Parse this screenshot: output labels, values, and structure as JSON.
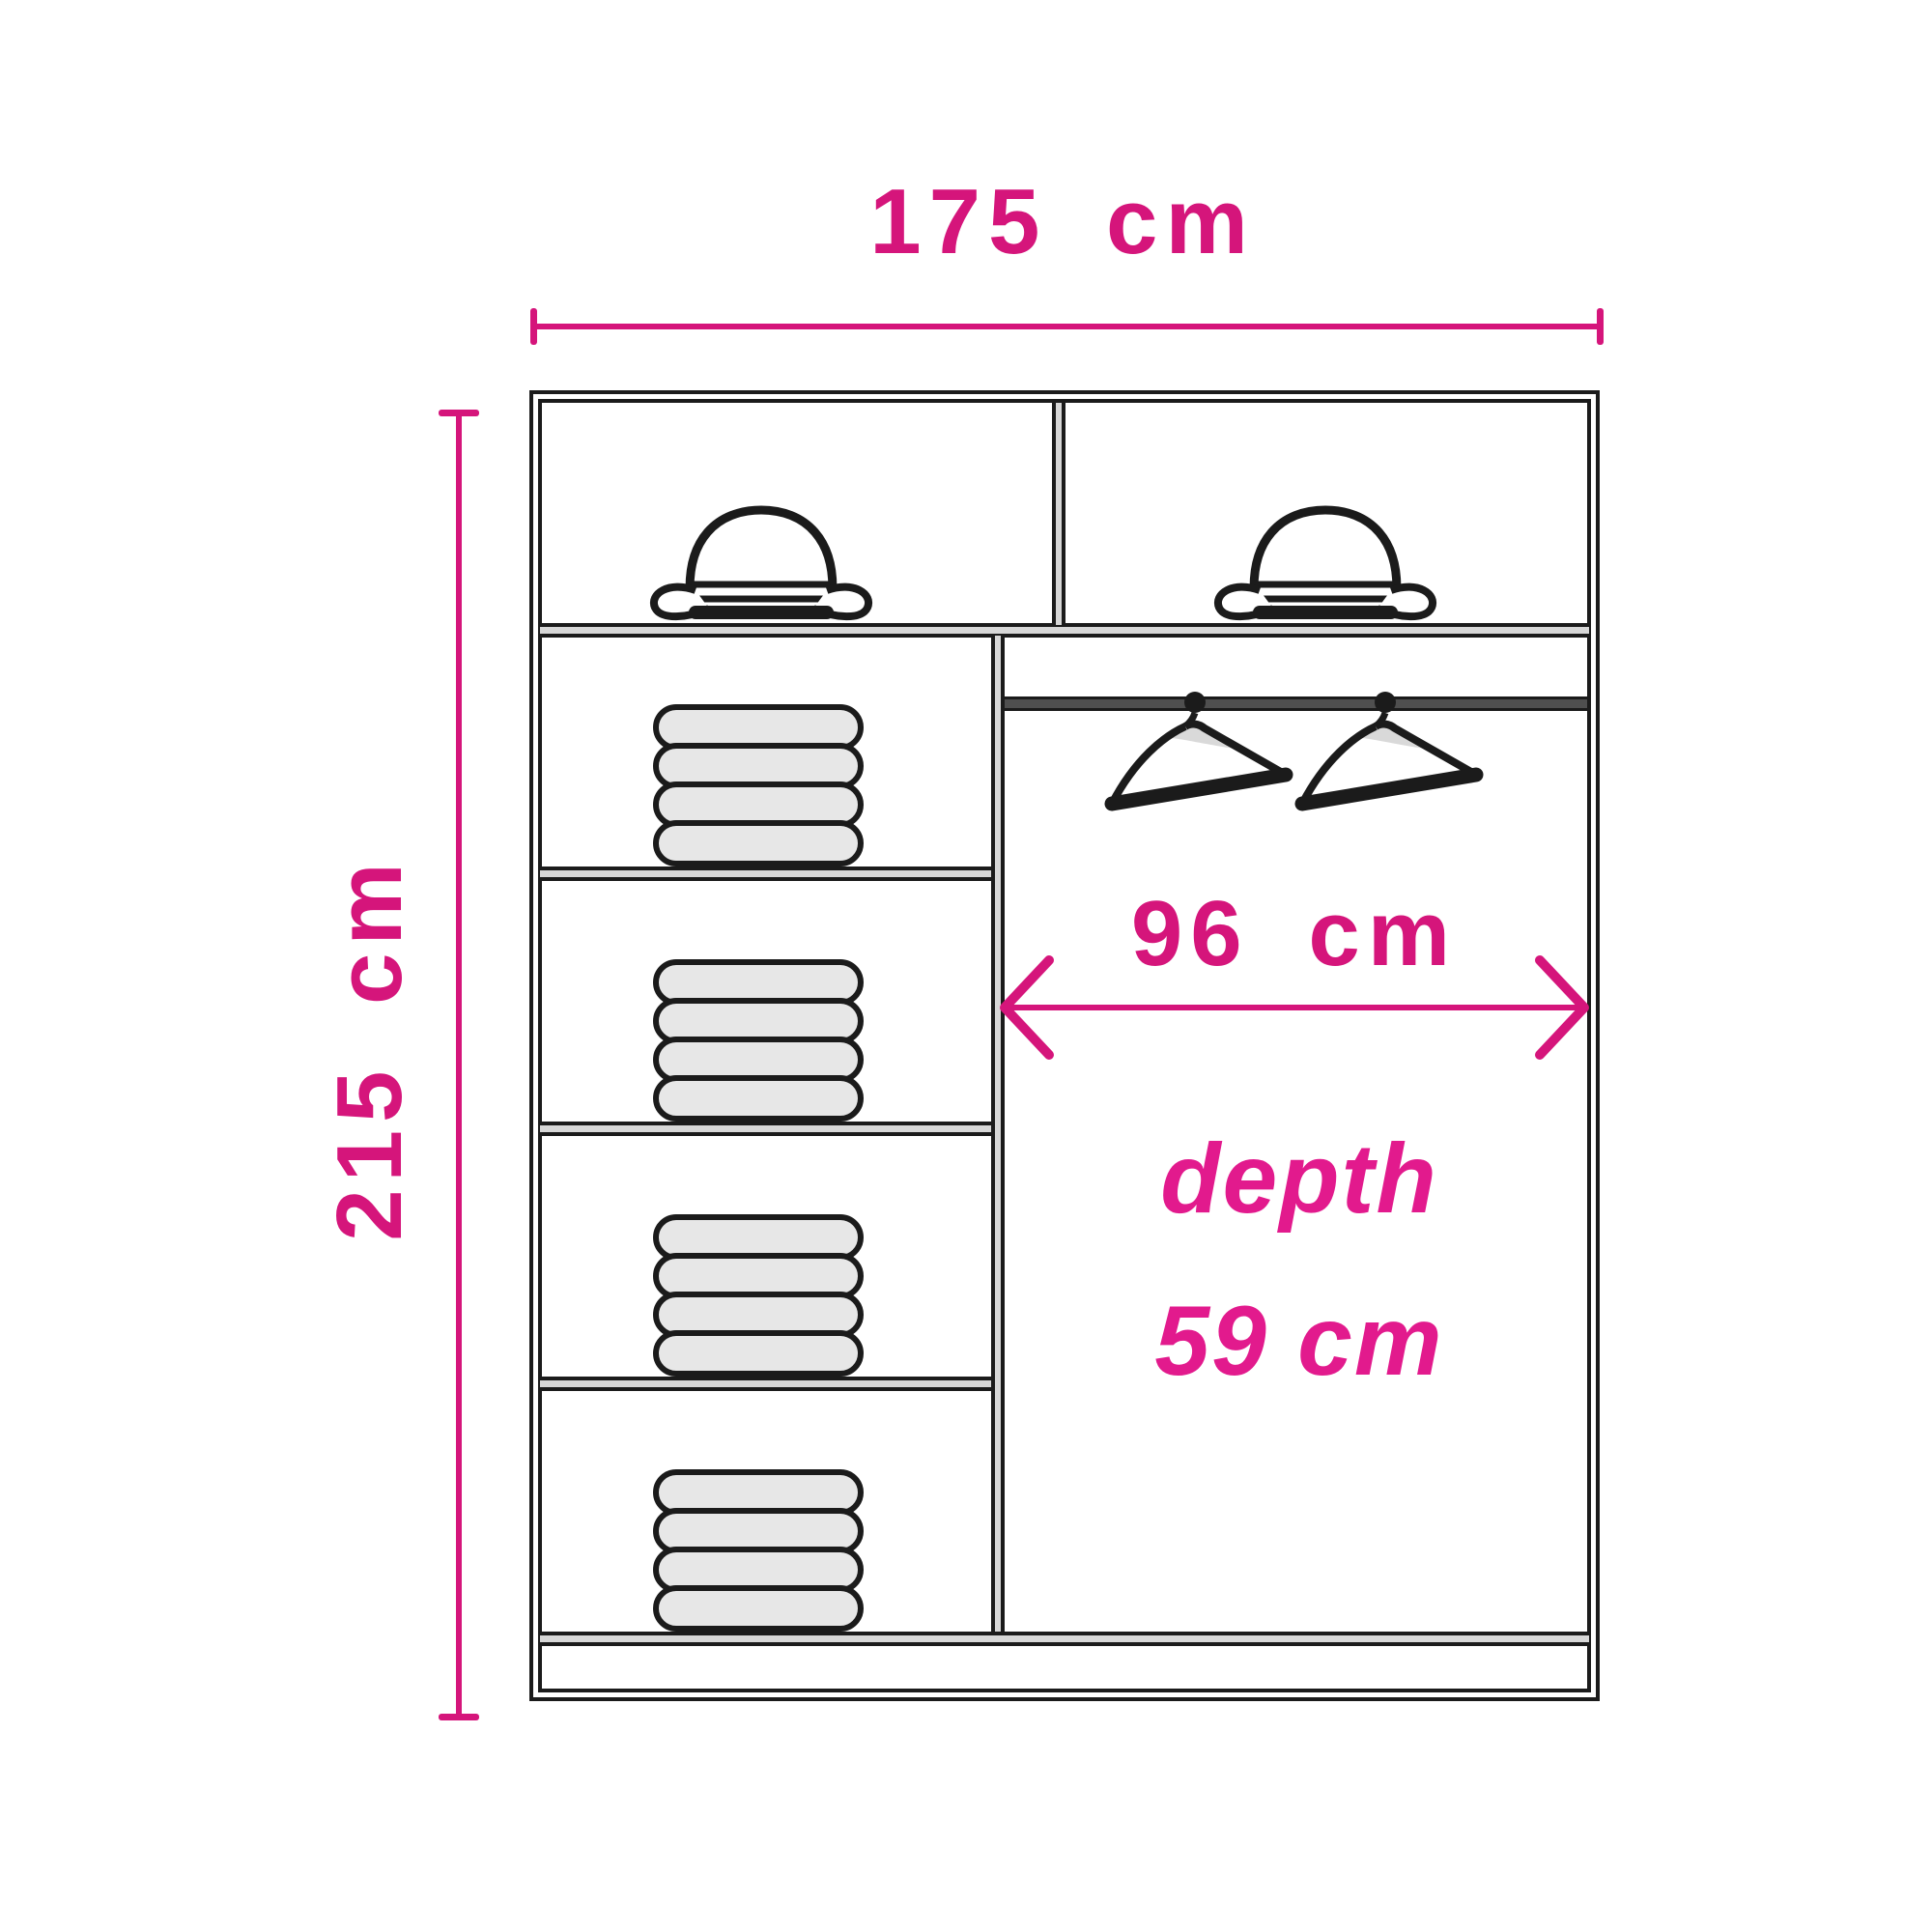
{
  "canvas": {
    "background": "#ffffff"
  },
  "colors": {
    "accent_pink": "#d5157b",
    "depth_pink": "#e21a8d",
    "line_dark": "#1b1b1b",
    "panel_grey": "#d7d7d7",
    "pill_grey": "#e7e7e7",
    "rail_grey": "#4f4f4f"
  },
  "dimensions": {
    "width_label": "175 cm",
    "height_label": "215 cm",
    "inner_width_label": "96 cm",
    "depth_label_line1": "depth",
    "depth_label_line2": "59 cm"
  },
  "wardrobe": {
    "top_hat_compartments": 2,
    "left_column_compartments": 4,
    "folded_clothes_stacks": 4,
    "items_per_stack": 4,
    "bowler_hats": 2,
    "clothes_hangers": 2
  }
}
